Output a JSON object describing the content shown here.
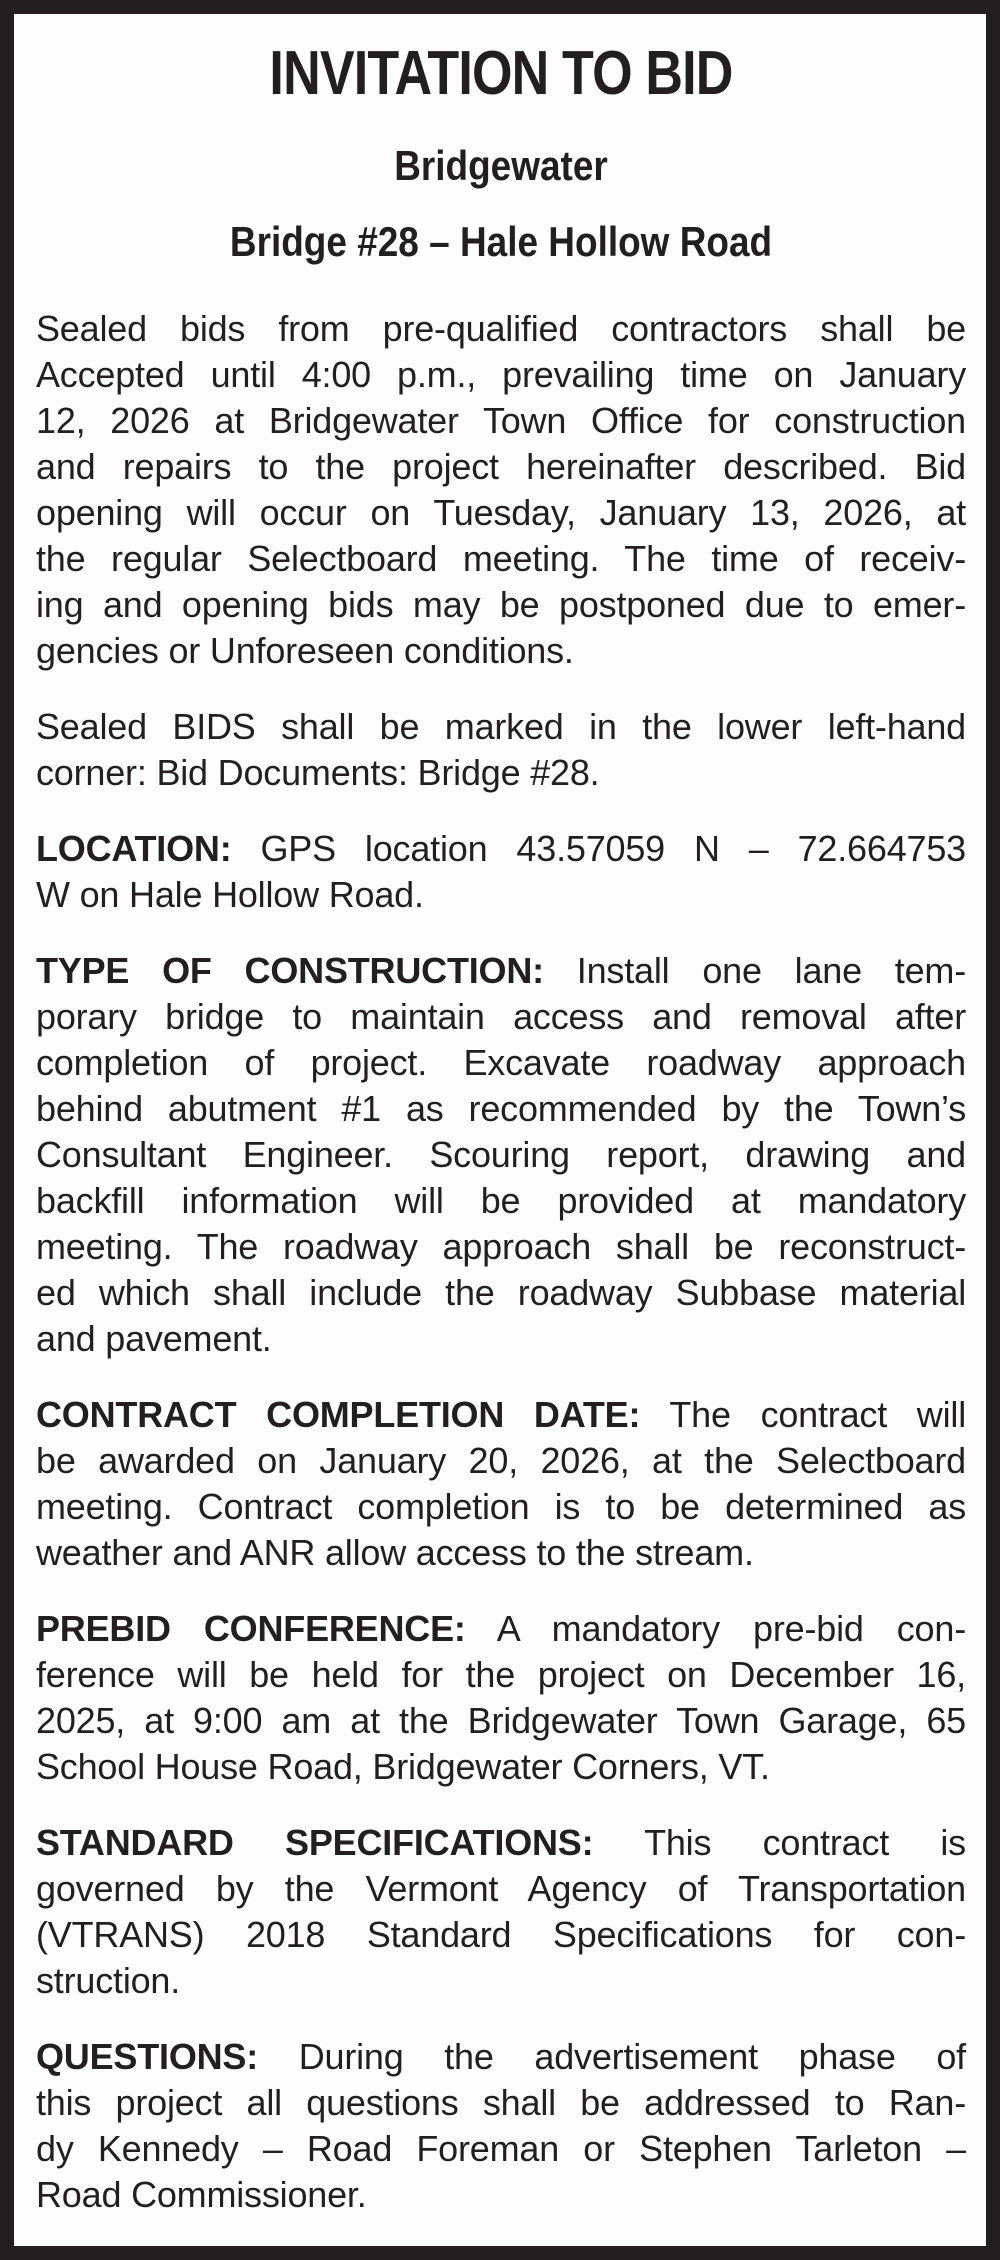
{
  "document": {
    "kind": "legal-notice",
    "title": "INVITATION TO BID",
    "subtitle": "Bridgewater",
    "subtitle2": "Bridge #28 – Hale Hollow Road",
    "colors": {
      "text": "#231f20",
      "border": "#231f20",
      "background": "#fdfdfd"
    },
    "paragraphs": [
      {
        "lead": "",
        "lines": [
          "Sealed bids from pre-qualified contractors shall be",
          "Accepted until 4:00 p.m., prevailing time on January",
          "12, 2026 at Bridgewater Town Office for construction",
          "and repairs to the project hereinafter described. Bid",
          "opening will occur on Tuesday, January 13, 2026, at",
          "the regular Selectboard meeting. The time of receiv-",
          "ing and opening bids may be postponed due to emer-",
          "gencies or Unforeseen conditions."
        ]
      },
      {
        "lead": "",
        "lines": [
          "Sealed BIDS shall be marked in the lower left-hand",
          "corner: Bid Documents: Bridge #28."
        ]
      },
      {
        "lead": "LOCATION:",
        "lines": [
          " GPS location 43.57059 N – 72.664753",
          "W on Hale Hollow Road."
        ]
      },
      {
        "lead": "TYPE OF CONSTRUCTION:",
        "lines": [
          " Install one lane tem-",
          "porary bridge to maintain access and removal after",
          "completion of project. Excavate roadway approach",
          "behind abutment #1 as recommended by the Town’s",
          "Consultant Engineer. Scouring report, drawing and",
          "backfill information will be provided at mandatory",
          "meeting. The roadway approach shall be reconstruct-",
          "ed which shall include the roadway Subbase material",
          "and pavement."
        ]
      },
      {
        "lead": "CONTRACT COMPLETION DATE:",
        "lines": [
          " The contract will",
          "be awarded on January 20, 2026, at the Selectboard",
          "meeting. Contract completion is to be determined as",
          "weather and ANR allow access to the stream."
        ]
      },
      {
        "lead": "PREBID CONFERENCE:",
        "lines": [
          " A mandatory pre-bid con-",
          "ference will be held for the project on December 16,",
          "2025, at 9:00 am at the Bridgewater Town Garage, 65",
          "School House Road, Bridgewater Corners, VT."
        ]
      },
      {
        "lead": "STANDARD SPECIFICATIONS:",
        "lines": [
          " This contract is",
          "governed by the Vermont Agency of Transportation",
          "(VTRANS) 2018 Standard Specifications for con-",
          "struction."
        ]
      },
      {
        "lead": "QUESTIONS:",
        "lines": [
          " During the advertisement phase of",
          "this project all questions shall be addressed to Ran-",
          "dy Kennedy – Road Foreman or Stephen Tarleton –",
          "Road Commissioner."
        ]
      }
    ]
  }
}
